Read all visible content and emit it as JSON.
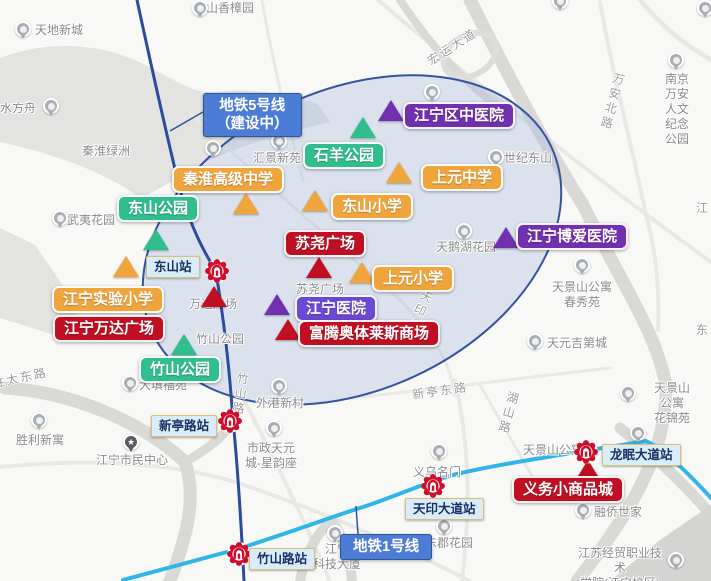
{
  "title": "江宁东山区域地图标注（楼盘周边配套示意图）",
  "colors": {
    "orange": "#F0A43C",
    "green": "#2FBE8C",
    "purple": "#7130AF",
    "violet": "#6A49D4",
    "red": "#C00E22",
    "line5": "#2A4D9B",
    "line1": "#2FB5E9",
    "label_blue": "#4D7CD6",
    "label_blue_border": "#2F5597",
    "station_bg": "#D8EDF9",
    "station_border": "#D9C072",
    "station_text": "#1A2F63",
    "metro_logo": "#CE0E2D",
    "ellipse_fill": "rgba(171,188,226,0.38)",
    "ellipse_border": "#33549F",
    "map_text": "#8A8A8E",
    "road_text": "#9C9C9C"
  },
  "metro_line_labels": [
    {
      "id": "line5-label",
      "text": "地铁5号线\n（建设中）",
      "x": 203,
      "y": 93
    },
    {
      "id": "line1-label",
      "text": "地铁1号线",
      "x": 340,
      "y": 534
    }
  ],
  "marker_boxes": [
    {
      "label": "江宁区中医院",
      "style": "purple",
      "x": 403,
      "y": 102
    },
    {
      "label": "石羊公园",
      "style": "green",
      "x": 303,
      "y": 142
    },
    {
      "label": "秦淮高级中学",
      "style": "orange",
      "x": 172,
      "y": 166
    },
    {
      "label": "上元中学",
      "style": "orange",
      "x": 421,
      "y": 164
    },
    {
      "label": "东山公园",
      "style": "green",
      "x": 117,
      "y": 195
    },
    {
      "label": "东山小学",
      "style": "orange",
      "x": 331,
      "y": 193
    },
    {
      "label": "江宁博爱医院",
      "style": "purple",
      "x": 516,
      "y": 223
    },
    {
      "label": "苏尧广场",
      "style": "red",
      "x": 284,
      "y": 230
    },
    {
      "label": "上元小学",
      "style": "orange",
      "x": 372,
      "y": 265
    },
    {
      "label": "江宁实验小学",
      "style": "orange",
      "x": 52,
      "y": 286
    },
    {
      "label": "江宁医院",
      "style": "violet",
      "x": 295,
      "y": 295
    },
    {
      "label": "江宁万达广场",
      "style": "red",
      "x": 53,
      "y": 315
    },
    {
      "label": "富腾奥体莱斯商场",
      "style": "red",
      "x": 298,
      "y": 320
    },
    {
      "label": "竹山公园",
      "style": "green",
      "x": 139,
      "y": 356
    },
    {
      "label": "义务小商品城",
      "style": "red",
      "x": 512,
      "y": 476
    }
  ],
  "station_boxes": [
    {
      "label": "东山站",
      "x": 146,
      "y": 256
    },
    {
      "label": "新亭路站",
      "x": 151,
      "y": 415
    },
    {
      "label": "竹山路站",
      "x": 249,
      "y": 548
    },
    {
      "label": "天印大道站",
      "x": 405,
      "y": 498
    },
    {
      "label": "龙眠大道站",
      "x": 602,
      "y": 444
    }
  ],
  "metro_icons": [
    {
      "station": "东山站",
      "x": 204,
      "y": 258
    },
    {
      "station": "新亭路站",
      "x": 217,
      "y": 408
    },
    {
      "station": "竹山路站",
      "x": 226,
      "y": 541
    },
    {
      "station": "天印大道站",
      "x": 420,
      "y": 473
    },
    {
      "station": "龙眠大道站",
      "x": 573,
      "y": 439
    }
  ],
  "triangles": [
    {
      "x": 363,
      "y": 117,
      "color": "green"
    },
    {
      "x": 391,
      "y": 100,
      "color": "purple"
    },
    {
      "x": 399,
      "y": 162,
      "color": "orange"
    },
    {
      "x": 156,
      "y": 229,
      "color": "green"
    },
    {
      "x": 126,
      "y": 256,
      "color": "orange"
    },
    {
      "x": 246,
      "y": 193,
      "color": "orange"
    },
    {
      "x": 315,
      "y": 190,
      "color": "orange"
    },
    {
      "x": 214,
      "y": 286,
      "color": "red"
    },
    {
      "x": 319,
      "y": 257,
      "color": "red"
    },
    {
      "x": 362,
      "y": 262,
      "color": "orange"
    },
    {
      "x": 277,
      "y": 294,
      "color": "purple"
    },
    {
      "x": 288,
      "y": 319,
      "color": "red"
    },
    {
      "x": 184,
      "y": 334,
      "color": "green"
    },
    {
      "x": 506,
      "y": 227,
      "color": "purple"
    },
    {
      "x": 588,
      "y": 460,
      "color": "red"
    }
  ],
  "map_pois": [
    {
      "text": "天地新城",
      "x": 59,
      "y": 23,
      "pin": [
        15,
        21
      ]
    },
    {
      "text": "东山香樟园",
      "x": 224,
      "y": 1,
      "pin": [
        192,
        0
      ]
    },
    {
      "text": "山水方舟",
      "x": 12,
      "y": 101,
      "pin": [
        43,
        98
      ]
    },
    {
      "text": "秦淮绿洲",
      "x": 106,
      "y": 144,
      "pin": null
    },
    {
      "text": "汇景新苑",
      "x": 277,
      "y": 151,
      "pin": [
        271,
        133
      ]
    },
    {
      "text": "世纪东山",
      "x": 528,
      "y": 151,
      "pin": [
        488,
        149
      ]
    },
    {
      "text": "南京万安人文\n纪念公园",
      "x": 677,
      "y": 72,
      "pin": [
        668,
        52
      ]
    },
    {
      "text": "武夷花园",
      "x": 91,
      "y": 213,
      "pin": [
        52,
        210
      ]
    },
    {
      "text": "天鹅湖花园",
      "x": 466,
      "y": 240,
      "pin": [
        456,
        223
      ]
    },
    {
      "text": "万达广场",
      "x": 213,
      "y": 297,
      "pin": null
    },
    {
      "text": "苏尧广场",
      "x": 320,
      "y": 282,
      "pin": null
    },
    {
      "text": "竹山公园",
      "x": 220,
      "y": 332,
      "pin": null
    },
    {
      "text": "天景山公寓\n春秀苑",
      "x": 582,
      "y": 280,
      "pin": [
        574,
        257
      ]
    },
    {
      "text": "天元吉第城",
      "x": 577,
      "y": 336,
      "pin": [
        527,
        333
      ]
    },
    {
      "text": "天景山公寓\n花锦苑",
      "x": 672,
      "y": 381,
      "pin": [
        620,
        385
      ]
    },
    {
      "text": "外港新村",
      "x": 280,
      "y": 396,
      "pin": [
        271,
        378
      ]
    },
    {
      "text": "大填福苑",
      "x": 163,
      "y": 378,
      "pin": [
        122,
        375
      ]
    },
    {
      "text": "胜利新寓",
      "x": 40,
      "y": 433,
      "pin": [
        31,
        412
      ]
    },
    {
      "text": "江宁市民中心",
      "x": 132,
      "y": 453,
      "pin": [
        123,
        434
      ],
      "icon": "star"
    },
    {
      "text": "市政天元\n城-星韵座",
      "x": 271,
      "y": 441,
      "pin": [
        266,
        420
      ]
    },
    {
      "text": "义乌名门",
      "x": 437,
      "y": 465,
      "pin": [
        431,
        443
      ]
    },
    {
      "text": "天景山公寓",
      "x": 553,
      "y": 443,
      "pin": null
    },
    {
      "text": "东郡花园",
      "x": 449,
      "y": 536,
      "pin": [
        436,
        518
      ]
    },
    {
      "text": "融侨世家",
      "x": 618,
      "y": 505,
      "pin": [
        575,
        502
      ]
    },
    {
      "text": "江宁\n科技大厦",
      "x": 337,
      "y": 542,
      "pin": [
        327,
        525
      ]
    },
    {
      "text": "江苏经贸职业技术\n学院(江宁校区)",
      "x": 620,
      "y": 546,
      "pin": [
        668,
        552
      ]
    }
  ],
  "road_labels": [
    {
      "text": "宏运大道",
      "x": 452,
      "y": 38,
      "rotate": -33,
      "vertical": false
    },
    {
      "text": "万安北路",
      "x": 604,
      "y": 72,
      "rotate": 15,
      "vertical": true
    },
    {
      "text": "天印大道",
      "x": 408,
      "y": 288,
      "rotate": 25,
      "vertical": true
    },
    {
      "text": "竹山路",
      "x": 232,
      "y": 372,
      "rotate": 8,
      "vertical": true
    },
    {
      "text": "湖山路",
      "x": 500,
      "y": 391,
      "rotate": 15,
      "vertical": true
    },
    {
      "text": "胜太东路",
      "x": 20,
      "y": 369,
      "rotate": -12,
      "vertical": false
    },
    {
      "text": "新亭东路",
      "x": 440,
      "y": 382,
      "rotate": -8,
      "vertical": false
    },
    {
      "text": "江",
      "x": 703,
      "y": 199,
      "rotate": 0,
      "vertical": false
    },
    {
      "text": "东",
      "x": 703,
      "y": 321,
      "rotate": 0,
      "vertical": false
    }
  ],
  "stray_pins": [
    [
      205,
      140
    ],
    [
      552,
      -7
    ],
    [
      697,
      0
    ],
    [
      424,
      84
    ],
    [
      630,
      425
    ]
  ]
}
